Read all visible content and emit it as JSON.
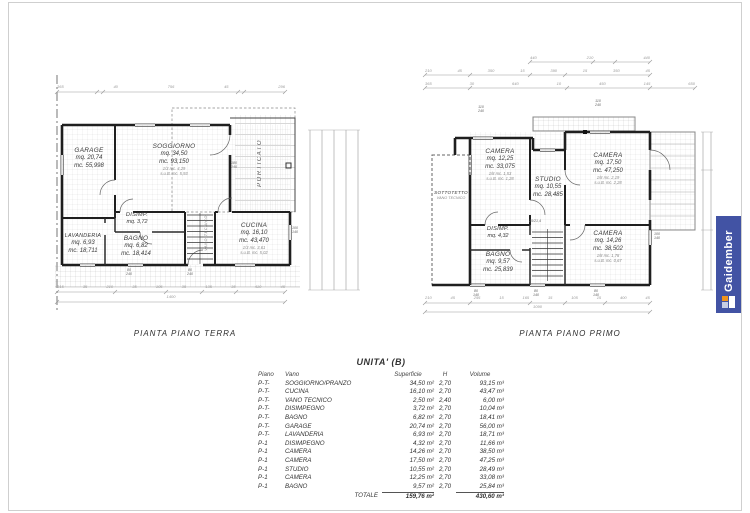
{
  "brand": {
    "name": "Gaidember",
    "banner_color": "#4253a4",
    "accent_color": "#f0941e"
  },
  "captions": {
    "terra": "PIANTA PIANO TERRA",
    "primo": "PIANTA PIANO PRIMO"
  },
  "terra": {
    "rooms": {
      "garage": {
        "name": "GARAGE",
        "l1": "mq. 20,74",
        "l2": "mc. 55,998"
      },
      "soggiorno": {
        "name": "SOGGIORNO",
        "l1": "mq. 34,50",
        "l2": "mc. 93,150",
        "t1": "1/3 mc. 4,29",
        "t2": "s.u.B. mc. 5,93"
      },
      "disimp": {
        "name": "DISIMP.",
        "l1": "mq. 3,72"
      },
      "lavanderia": {
        "name": "LAVANDERIA",
        "l1": "mq. 6,93",
        "l2": "mc. 18,711"
      },
      "bagno": {
        "name": "BAGNO",
        "l1": "mq. 6,82",
        "l2": "mc. 18,414"
      },
      "cucina": {
        "name": "CUCINA",
        "l1": "mq. 16,10",
        "l2": "mc. 43,470",
        "t1": "1/3 mc. 3,61",
        "t2": "s.u.B. mc. 5,02"
      },
      "porticato": "PORTICATO",
      "vano": "VANO TECNICO"
    },
    "windows": {
      "w1": "180\n140",
      "w2": "100\n140",
      "w3": "80\n240",
      "w4": "80\n240"
    },
    "dims": {
      "top": [
        "365",
        "40",
        "756",
        "45",
        "296"
      ],
      "bottom": [
        "315",
        "35",
        "210",
        "35",
        "105",
        "35",
        "135",
        "35",
        "410",
        "45"
      ],
      "total": "1400"
    }
  },
  "primo": {
    "rooms": {
      "camera1": {
        "name": "CAMERA",
        "l1": "mq. 12,25",
        "l2": "mc. 33,075",
        "t1": "1/8 mc. 1,53",
        "t2": "s.u.B. mc. 1,28"
      },
      "studio": {
        "name": "STUDIO",
        "l1": "mq. 10,55",
        "l2": "mc. 28,485"
      },
      "camera2": {
        "name": "CAMERA",
        "l1": "mq. 17,50",
        "l2": "mc. 47,250",
        "t1": "1/8 mc. 2,19",
        "t2": "s.u.B. mc. 2,28"
      },
      "disimp": {
        "name": "DISIMP.",
        "l1": "mq. 4,32"
      },
      "bagno": {
        "name": "BAGNO",
        "l1": "mq. 9,57",
        "l2": "mc. 25,839"
      },
      "camera3": {
        "name": "CAMERA",
        "l1": "mq. 14,26",
        "l2": "mc. 38,502",
        "t1": "1/8 mc. 1,78",
        "t2": "s.u.B. mc. 0,67"
      },
      "sottotetto": "SOTTOTETTO",
      "sottotetto2": "VANO TECNICO",
      "stairnote": "25/21,4"
    },
    "windows": {
      "w1": "110\n240",
      "w2": "110\n240",
      "w3": "100\n140",
      "w4": "80\n140",
      "w5": "80\n140",
      "w6": "80\n140"
    },
    "dims": {
      "top1": [
        "440",
        "210",
        "440"
      ],
      "top2": [
        "210",
        "45",
        "350",
        "15",
        "390",
        "15",
        "350",
        "45"
      ],
      "top3": [
        "365",
        "30",
        "640",
        "10",
        "450",
        "145",
        "650"
      ],
      "bottom": [
        "210",
        "45",
        "295",
        "15",
        "165",
        "15",
        "105",
        "15",
        "400",
        "45"
      ],
      "total": "1090"
    }
  },
  "table": {
    "title": "UNITA' (B)",
    "headers": {
      "piano": "Piano",
      "vano": "Vano",
      "sup": "Superficie",
      "h": "H",
      "vol": "Volume"
    },
    "rows": [
      {
        "piano": "P-T-",
        "vano": "SOGGIORNO/PRANZO",
        "sup": "34,50 m²",
        "h": "2,70",
        "vol": "93,15 m³"
      },
      {
        "piano": "P-T-",
        "vano": "CUCINA",
        "sup": "16,10 m²",
        "h": "2,70",
        "vol": "43,47 m³"
      },
      {
        "piano": "P-T-",
        "vano": "VANO TECNICO",
        "sup": "2,50 m²",
        "h": "2,40",
        "vol": "6,00 m³"
      },
      {
        "piano": "P-T-",
        "vano": "DISIMPEGNO",
        "sup": "3,72 m²",
        "h": "2,70",
        "vol": "10,04 m³"
      },
      {
        "piano": "P-T-",
        "vano": "BAGNO",
        "sup": "6,82 m²",
        "h": "2,70",
        "vol": "18,41 m³"
      },
      {
        "piano": "P-T-",
        "vano": "GARAGE",
        "sup": "20,74 m²",
        "h": "2,70",
        "vol": "56,00 m³"
      },
      {
        "piano": "P-T-",
        "vano": "LAVANDERIA",
        "sup": "6,93 m²",
        "h": "2,70",
        "vol": "18,71 m³"
      },
      {
        "piano": "P-1",
        "vano": "DISIMPEGNO",
        "sup": "4,32 m²",
        "h": "2,70",
        "vol": "11,66 m³"
      },
      {
        "piano": "P-1",
        "vano": "CAMERA",
        "sup": "14,26 m²",
        "h": "2,70",
        "vol": "38,50 m³"
      },
      {
        "piano": "P-1",
        "vano": "CAMERA",
        "sup": "17,50 m²",
        "h": "2,70",
        "vol": "47,25 m³"
      },
      {
        "piano": "P-1",
        "vano": "STUDIO",
        "sup": "10,55 m²",
        "h": "2,70",
        "vol": "28,49 m³"
      },
      {
        "piano": "P-1",
        "vano": "CAMERA",
        "sup": "12,25 m²",
        "h": "2,70",
        "vol": "33,08 m³"
      },
      {
        "piano": "P-1",
        "vano": "BAGNO",
        "sup": "9,57 m²",
        "h": "2,70",
        "vol": "25,84 m³"
      }
    ],
    "total": {
      "label": "TOTALE",
      "sup": "159,76 m²",
      "vol": "430,60 m³"
    }
  }
}
